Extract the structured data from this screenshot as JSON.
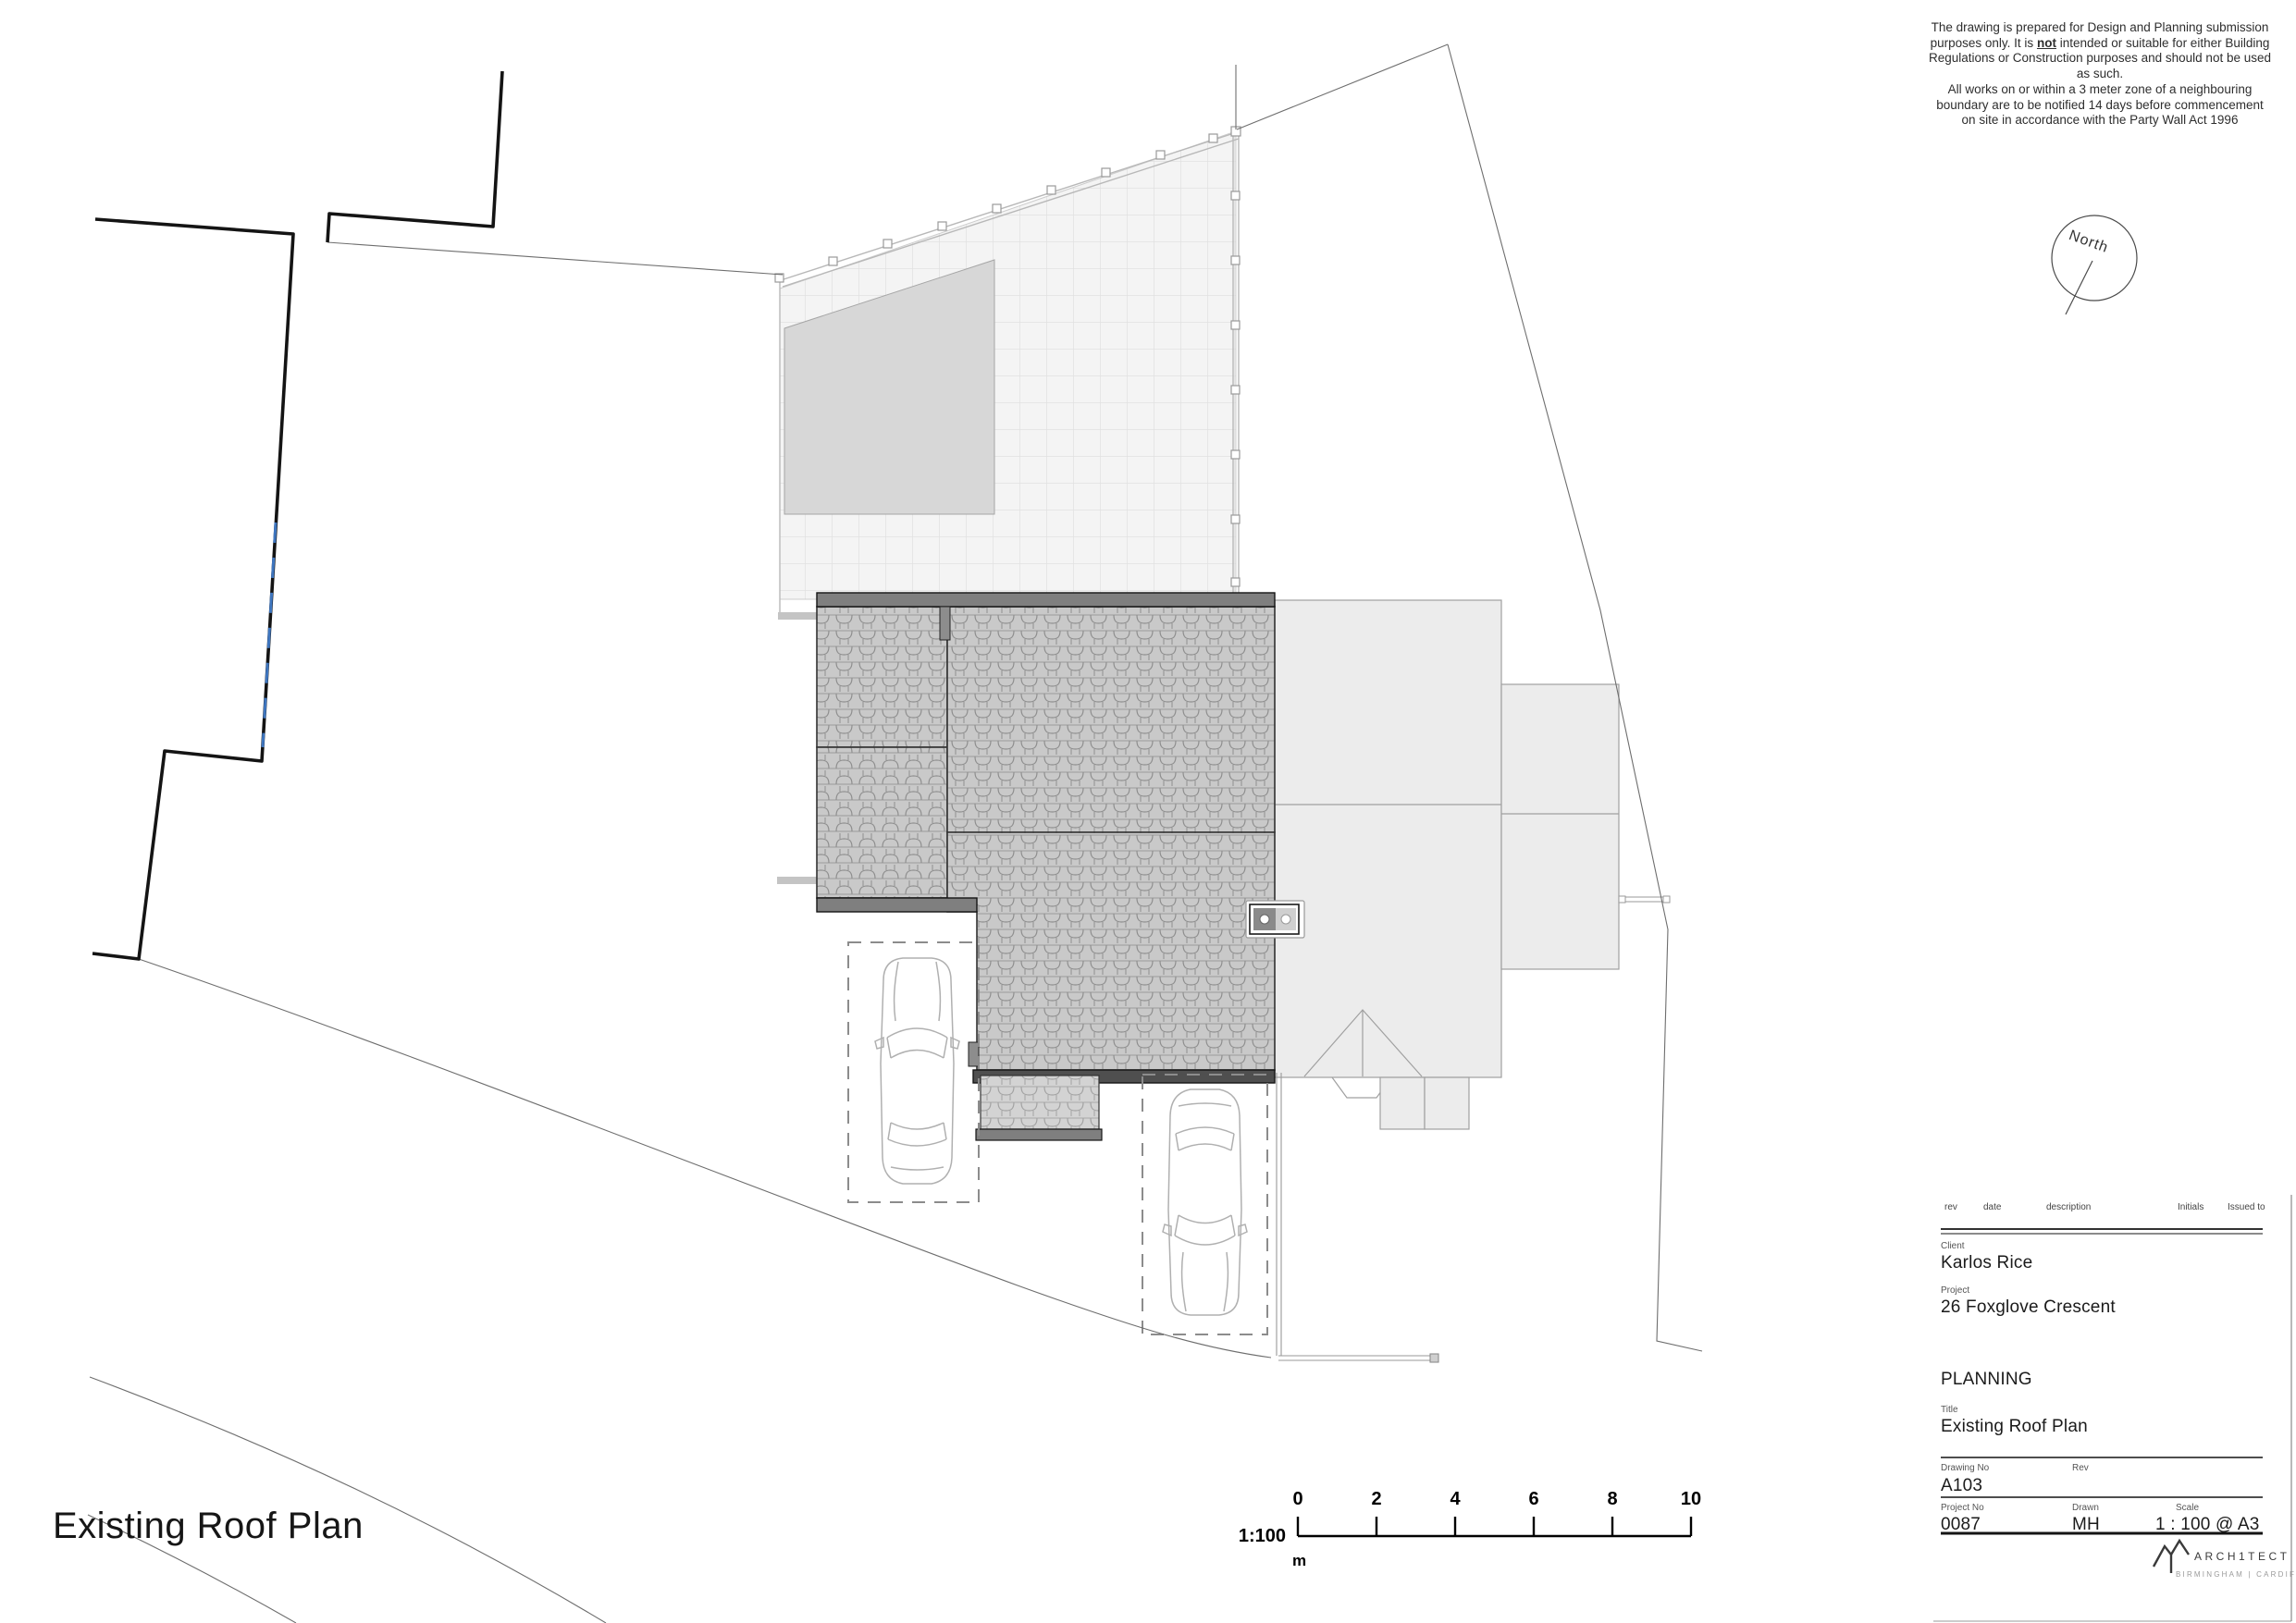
{
  "drawing": {
    "sheet_title": "Existing Roof Plan",
    "north": {
      "label": "North"
    }
  },
  "disclaimer": {
    "part1": "The drawing is prepared for Design and Planning submission purposes only. It is",
    "not_word": "not",
    "part2": "intended or suitable for either Building Regulations or Construction purposes and should not be used as such.",
    "part3": "All works on or within a 3 meter zone of a neighbouring boundary are to be notified 14 days before commencement on site in accordance with the Party Wall Act 1996"
  },
  "scalebar": {
    "ratio": "1:100",
    "unit": "m",
    "ticks": [
      "0",
      "2",
      "4",
      "6",
      "8",
      "10"
    ]
  },
  "titleblock": {
    "rev_header": "rev",
    "date_header": "date",
    "description_header": "description",
    "initials_header": "Initials",
    "issued_to_header": "Issued to",
    "client_label": "Client",
    "client": "Karlos Rice",
    "project_label": "Project",
    "project": "26 Foxglove Crescent",
    "stage": "PLANNING",
    "title_label": "Title",
    "title": "Existing Roof Plan",
    "drawing_no_label": "Drawing No",
    "drawing_no": "A103",
    "rev_label": "Rev",
    "project_no_label": "Project No",
    "project_no": "0087",
    "drawn_label": "Drawn",
    "drawn": "MH",
    "scale_label": "Scale",
    "scale": "1 : 100 @ A3",
    "logo_text": "ARCH1TECT",
    "logo_sub": "BIRMINGHAM | CARDIFF"
  },
  "colors": {
    "boundary": "#141414",
    "boundary_marker_blue": "#3f76bf",
    "roof_tile": "#c9c9c9",
    "fascia": "#7f7f7f",
    "neighbour_fill": "#ececec",
    "patio_fill": "#f4f4f4",
    "shed_fill": "#d7d7d7"
  }
}
